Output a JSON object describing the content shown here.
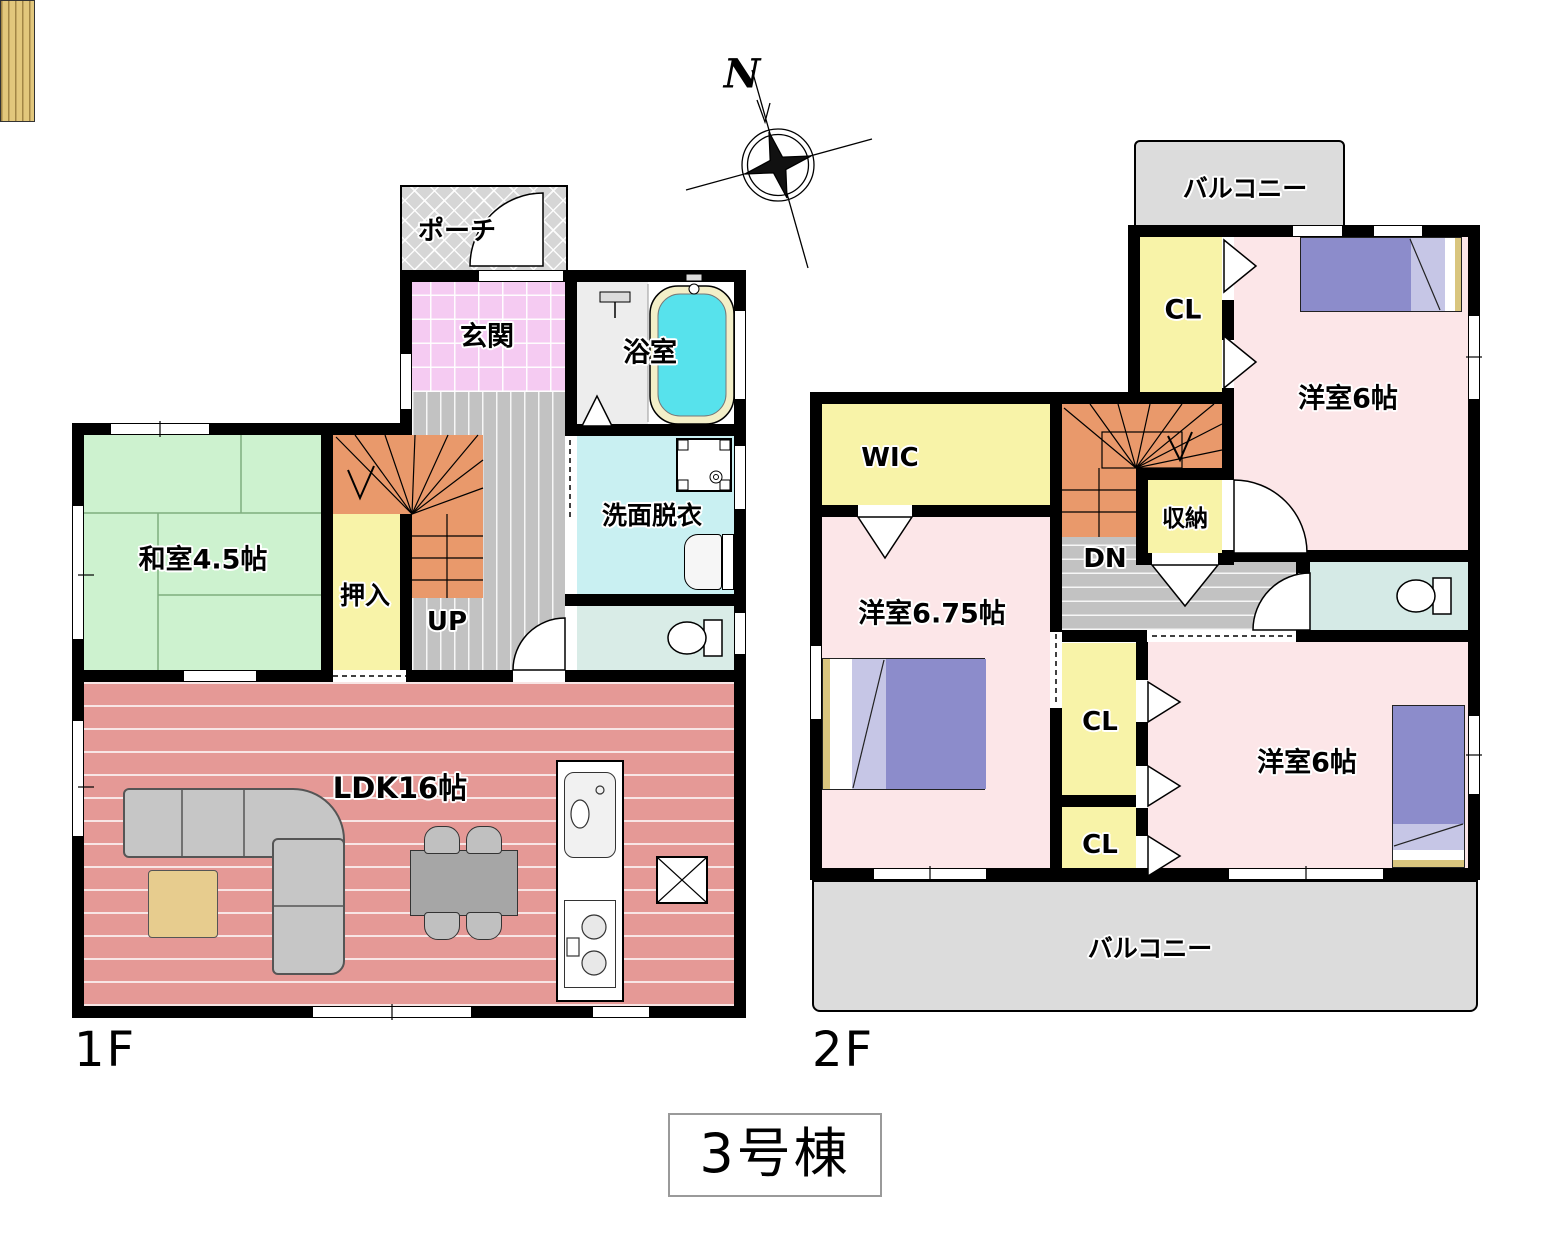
{
  "title": {
    "text": "3号棟"
  },
  "compass": {
    "north": "N"
  },
  "floor1": {
    "label": "1F",
    "porch": "ポーチ",
    "entrance": "玄関",
    "bathroom": "浴室",
    "japanese_room": "和室4.5帖",
    "closet": "押入",
    "stairs_up": "UP",
    "washroom": "洗面脱衣",
    "ldk": "LDK16帖"
  },
  "floor2": {
    "label": "2F",
    "balcony_north": "バルコニー",
    "closet_north": "CL",
    "bedroom_north": "洋室6帖",
    "wic": "WIC",
    "storage": "収納",
    "stairs_down": "DN",
    "bedroom_west": "洋室6.75帖",
    "closet_mid": "CL",
    "closet_south": "CL",
    "bedroom_south": "洋室6帖",
    "balcony_south": "バルコニー"
  },
  "colors": {
    "wall": "#000000",
    "tatami_green": "#cdf2cf",
    "ldk_salmon": "#e59996",
    "closet_yellow": "#f8f3a8",
    "stairs_orange": "#e9996b",
    "bedroom_pink": "#fce6e8",
    "entrance_pink": "#f5cbf2",
    "washroom_cyan": "#c9f0f2",
    "bathtub_cyan": "#57e2ec",
    "toilet_green": "#d9ece7",
    "balcony_gray": "#dcdcdc",
    "bed_purple": "#8c8ccb"
  }
}
